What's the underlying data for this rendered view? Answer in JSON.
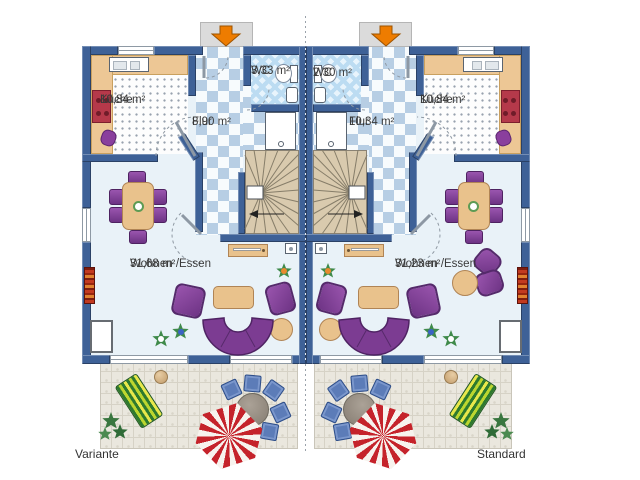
{
  "units": [
    {
      "caption": "Variante",
      "rooms": {
        "kueche": {
          "name": "Küche",
          "area": "10,84 m²"
        },
        "flur": {
          "name": "Flur",
          "area": "8,90 m²"
        },
        "wc": {
          "name": "WC",
          "area": "3,33 m²"
        },
        "wohnen": {
          "name": "Wohnen /Essen",
          "area": "31,68 m²"
        }
      }
    },
    {
      "caption": "Standard",
      "rooms": {
        "kueche": {
          "name": "Küche",
          "area": "10,84 m²"
        },
        "flur": {
          "name": "Flur",
          "area": "10,34 m²"
        },
        "wc": {
          "name": "WC",
          "area": "2,30 m²"
        },
        "wohnen": {
          "name": "Wohnen /Essen",
          "area": "31,23 m²"
        }
      }
    }
  ],
  "icons": {
    "entrance_arrow": "arrow-down-icon"
  },
  "colors": {
    "wall": "#3e6197",
    "entrance_arrow": "#ee7c00",
    "floor_living": "#e9f2f8",
    "floor_flur_check": "#b7cee4",
    "floor_wc": "#bcdcf2",
    "furniture_purple": "#7c3c92",
    "furniture_wood": "#e9c28c",
    "stove_red": "#b5394a",
    "umbrella_red": "#c5232b",
    "terrace": "#eae7de",
    "stairs": "#d9caae",
    "chair_blue": "#5c7cb8",
    "lounge_green": "#2e7a2e"
  }
}
